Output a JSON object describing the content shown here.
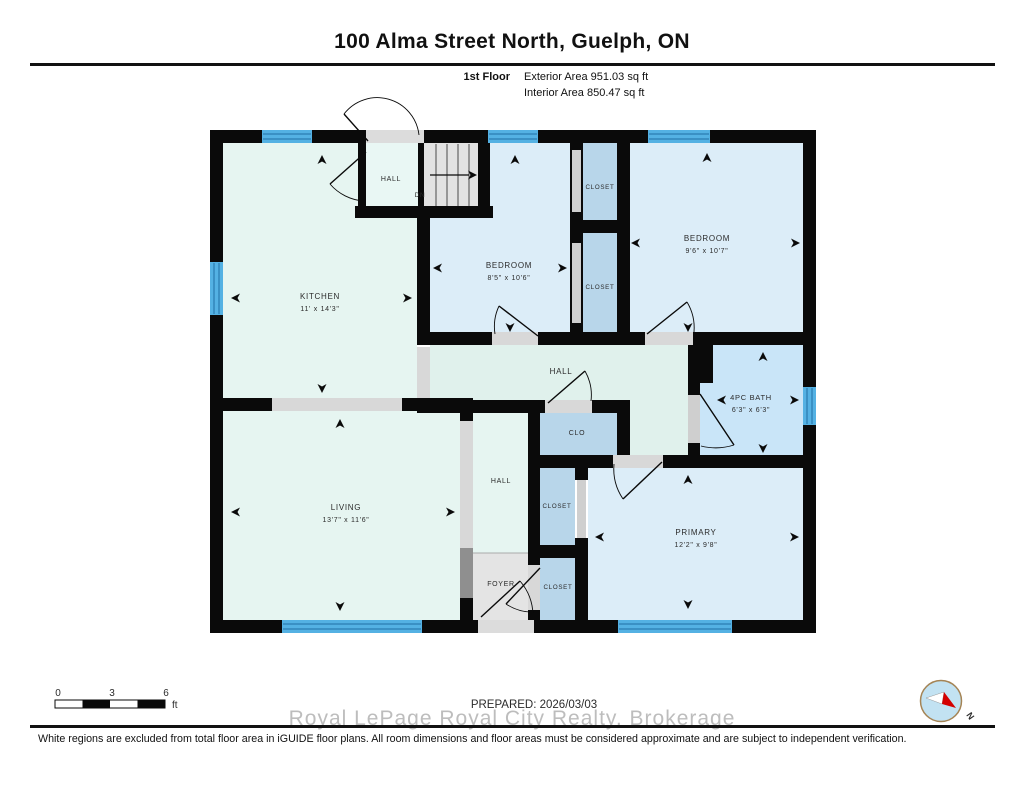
{
  "header": {
    "title": "100 Alma Street North, Guelph, ON",
    "floor_label": "1st Floor",
    "exterior_area": "Exterior Area 951.03 sq ft",
    "interior_area": "Interior Area 850.47 sq ft"
  },
  "plan": {
    "rooms": {
      "kitchen": {
        "label": "KITCHEN",
        "dims": "11' x 14'3\""
      },
      "bedroom_mid": {
        "label": "BEDROOM",
        "dims": "8'5\" x 10'6\""
      },
      "bedroom_right": {
        "label": "BEDROOM",
        "dims": "9'6\" x 10'7\""
      },
      "bath": {
        "label": "4PC BATH",
        "dims": "6'3\" x 6'3\""
      },
      "living": {
        "label": "LIVING",
        "dims": "13'7\" x 11'6\""
      },
      "primary": {
        "label": "PRIMARY",
        "dims": "12'2\" x 9'8\""
      },
      "hall_top": {
        "label": "HALL"
      },
      "hall_center": {
        "label": "HALL"
      },
      "hall_lower": {
        "label": "HALL"
      },
      "foyer": {
        "label": "FOYER"
      },
      "clo": {
        "label": "CLO"
      },
      "closet_top1": {
        "label": "CLOSET"
      },
      "closet_top2": {
        "label": "CLOSET"
      },
      "closet_mid": {
        "label": "CLOSET"
      },
      "closet_bottom": {
        "label": "CLOSET"
      }
    },
    "stairs": {
      "dn_label": "DN"
    },
    "colors": {
      "mint_room": "#e6f5f1",
      "hall": "#e0f1ec",
      "bedroom": "#dcedf8",
      "closet": "#b8d6ea",
      "bath": "#c9e5f8",
      "window": "#54b1e3",
      "window_stripe": "#1f6ea6",
      "wall": "#0a0a0a",
      "excluded_gray": "#e2e2e2"
    }
  },
  "scale_bar": {
    "tick_0": "0",
    "tick_3": "3",
    "tick_6": "6",
    "unit": "ft"
  },
  "compass": {
    "north_label": "N"
  },
  "footer": {
    "prepared": "PREPARED: 2026/03/03",
    "watermark": "Royal LePage Royal City Realty, Brokerage",
    "disclaimer": "White regions are excluded from total floor area in iGUIDE floor plans. All room dimensions and floor areas must be considered approximate and are subject to independent verification."
  }
}
